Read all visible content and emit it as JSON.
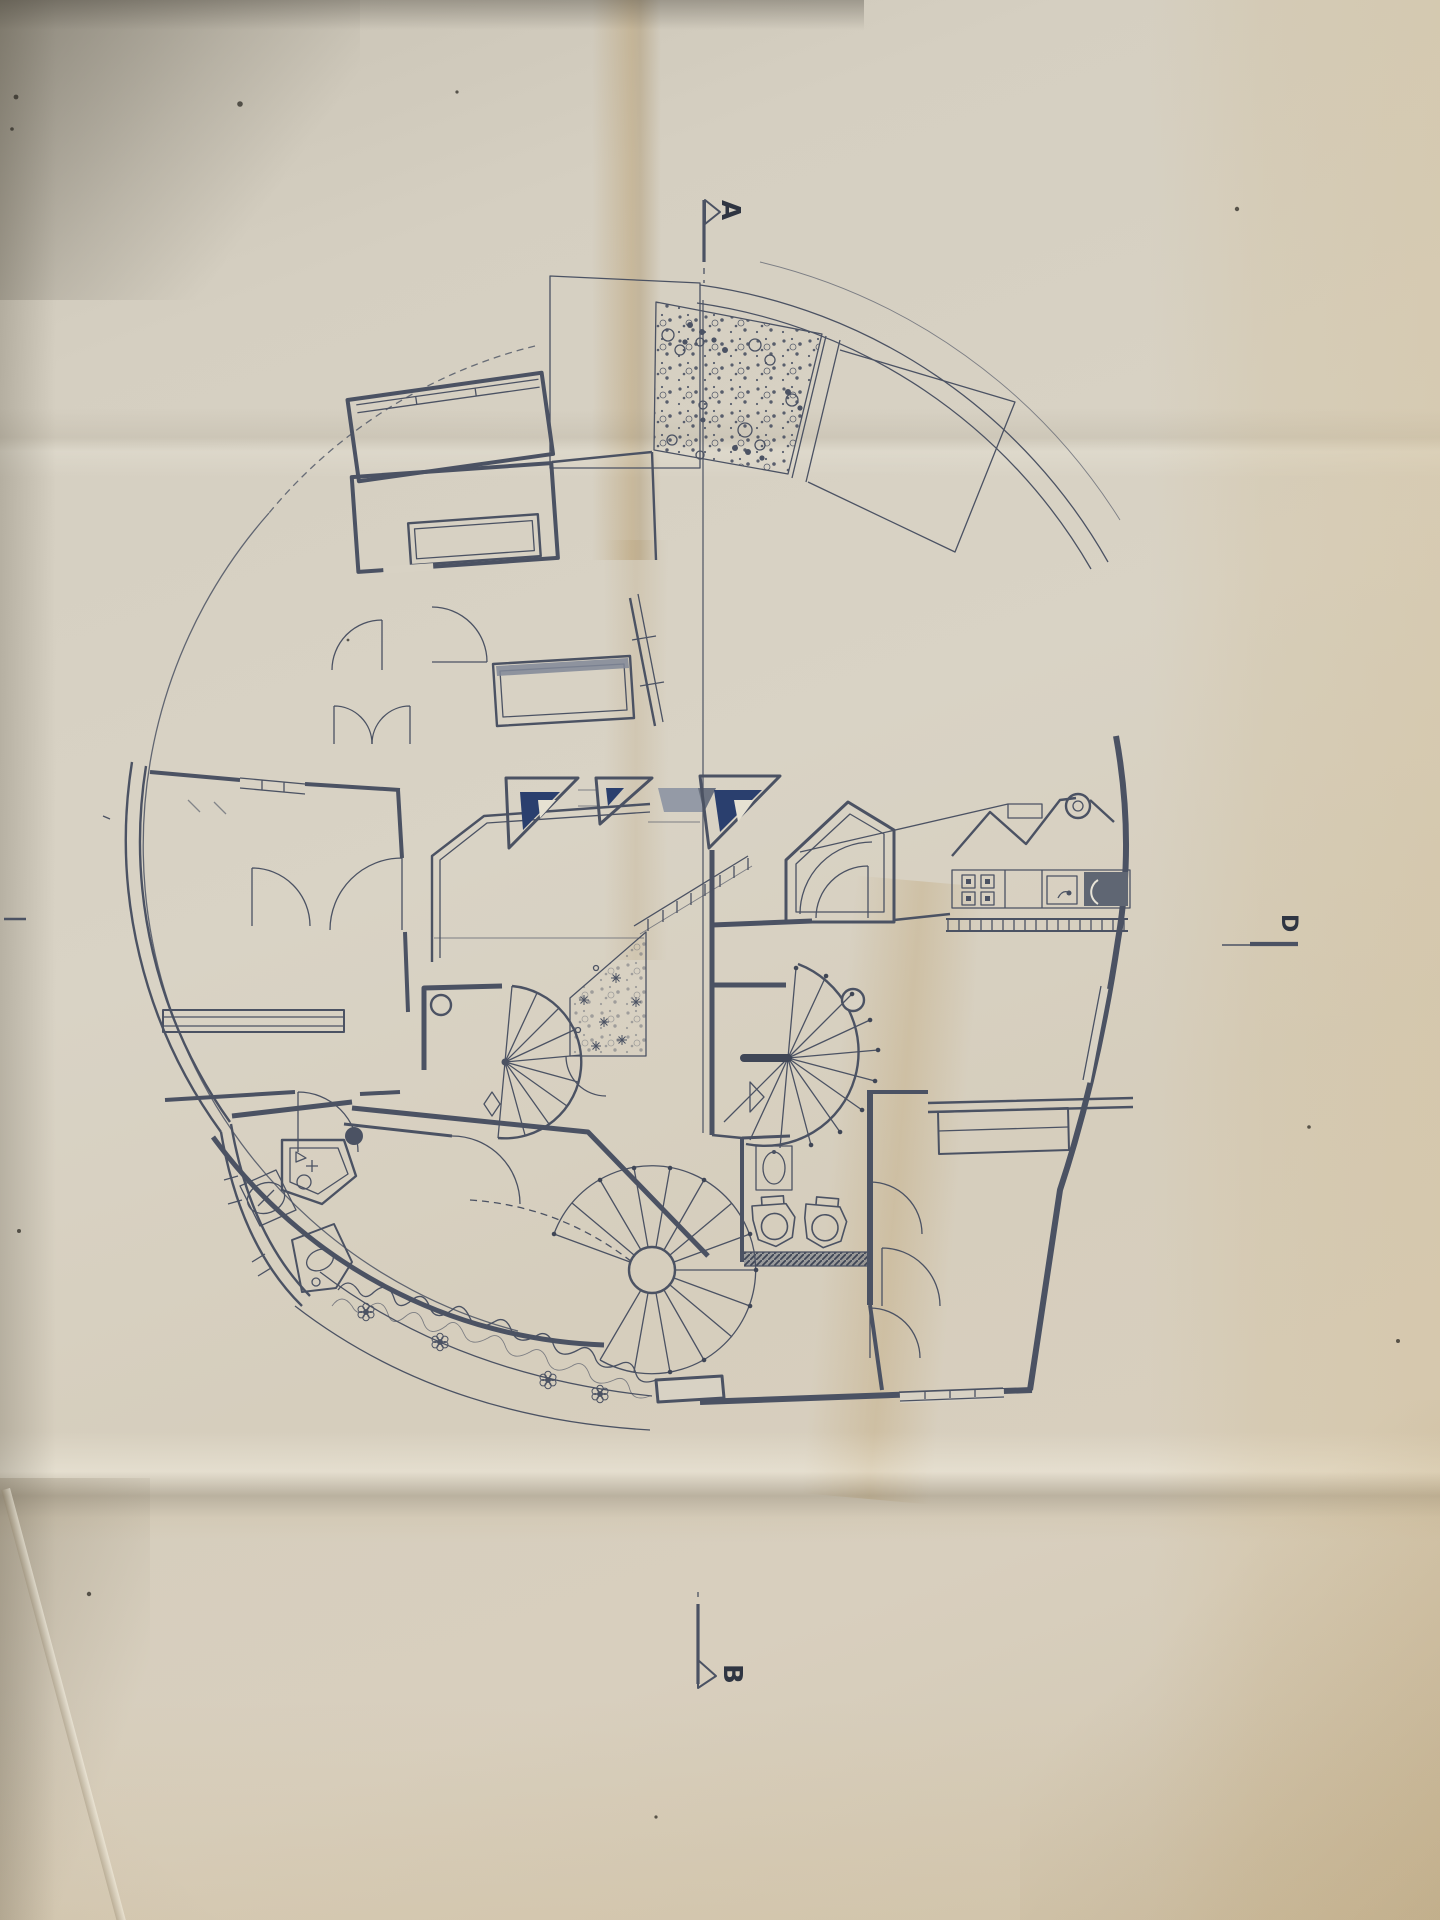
{
  "section_markers": {
    "a": {
      "label": "A"
    },
    "b": {
      "label": "B"
    },
    "d": {
      "label": "D"
    }
  },
  "palette": {
    "paper": "#d8d2c4",
    "paper_warm": "#d2c7b1",
    "ink": "#4b5263",
    "ink_dark": "#2f3542",
    "navy_glazing": "#2a3f6e",
    "gray_fill": "#949aa6",
    "appliance_dark": "#5f6673",
    "crease_tan": "#c9ab78"
  }
}
